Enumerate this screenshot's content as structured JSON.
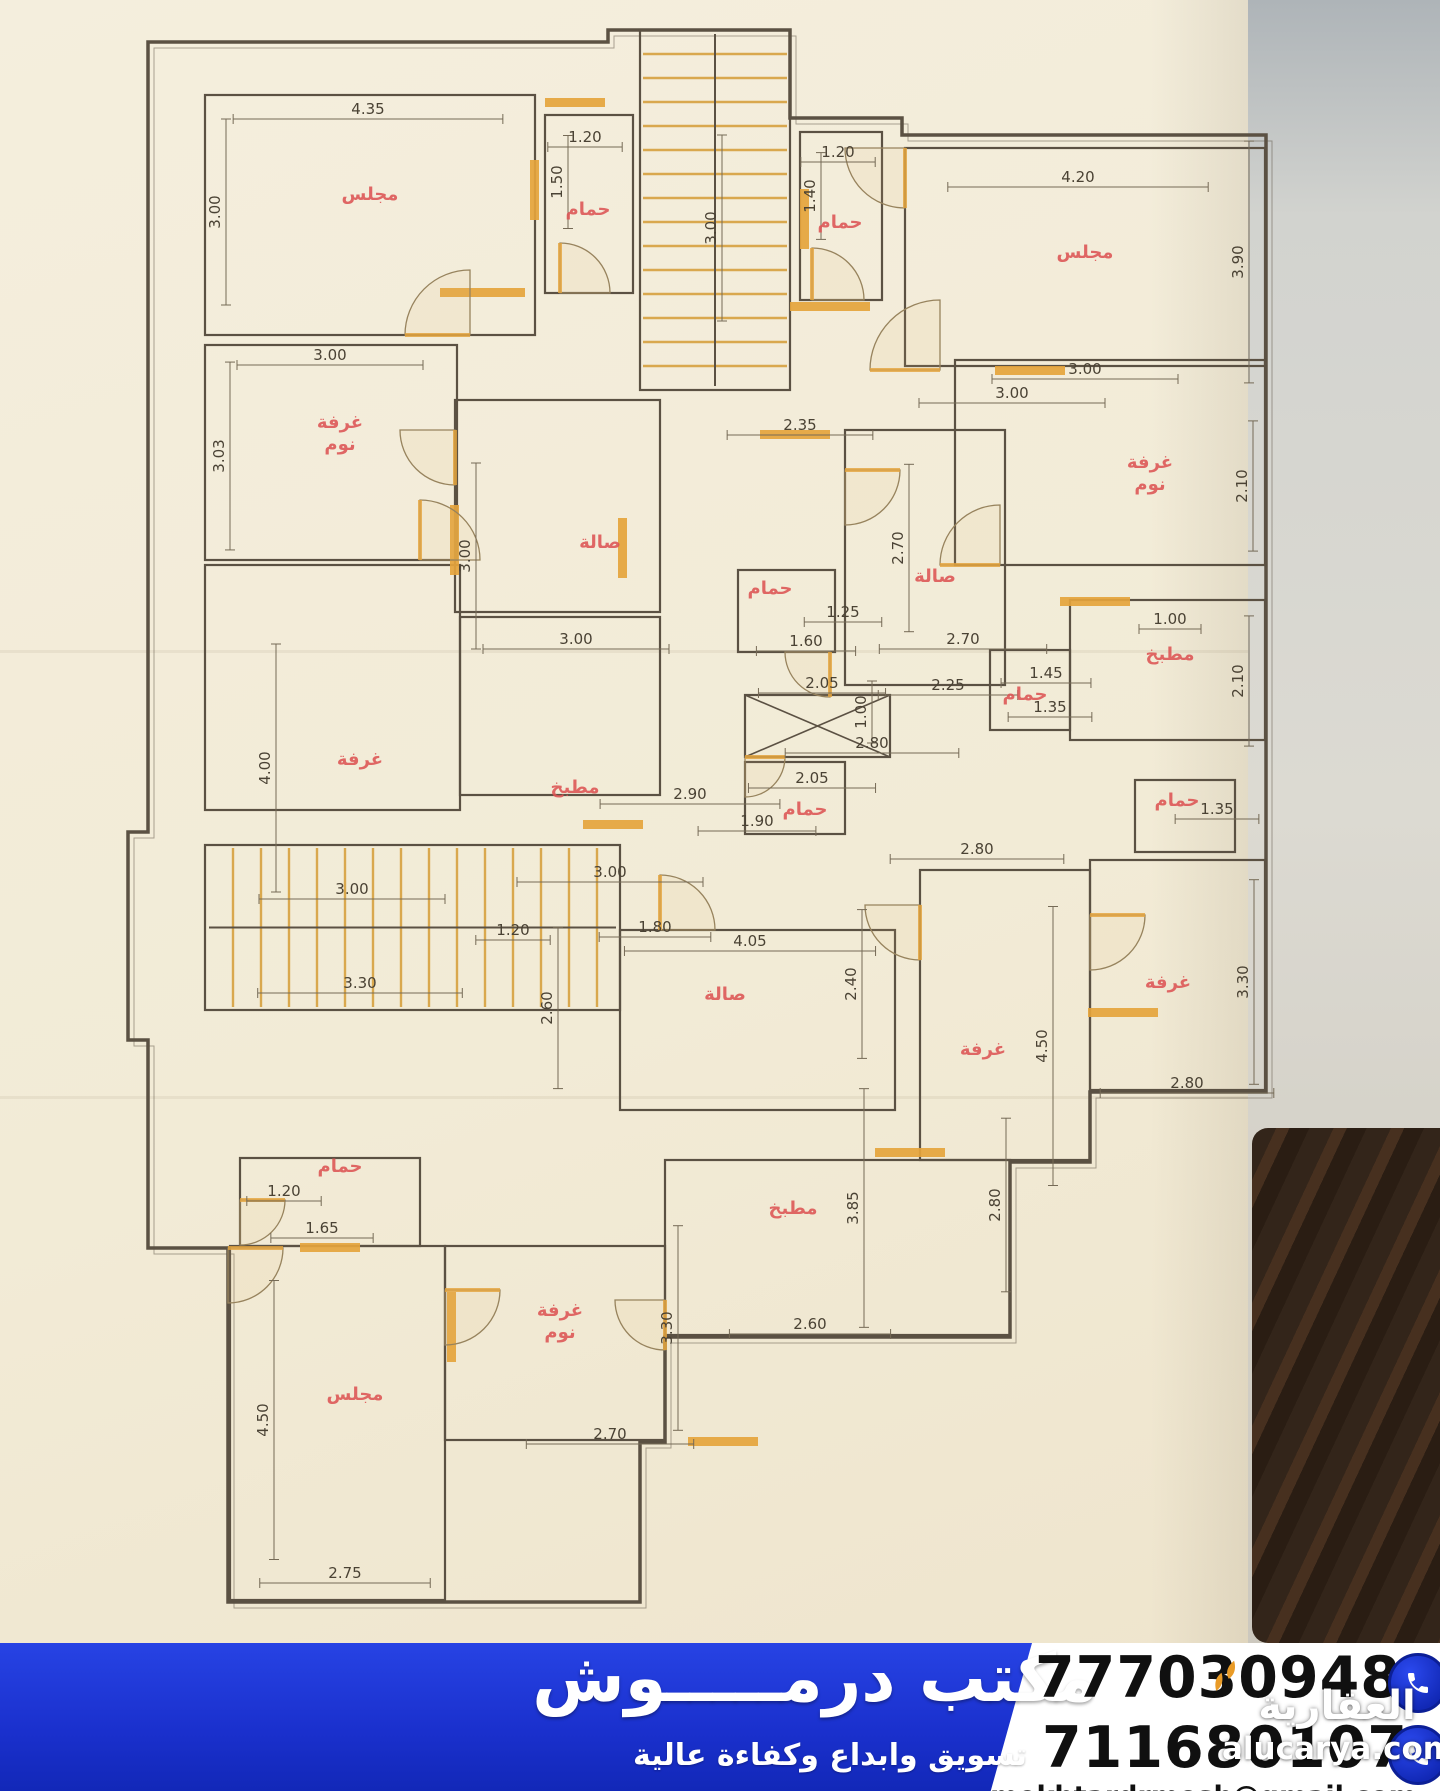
{
  "photo": {
    "paper_color": "#f2ebd6",
    "wall_color": "#d2d3cf",
    "dark_object_color": "#33251a",
    "crease_y1": 650,
    "crease_y2": 1096
  },
  "plan": {
    "ink": "#5b5143",
    "dim": "#4a4234",
    "dimline": "#756a56",
    "label": "#dd5454",
    "column_red": "#f3503a",
    "column_pink": "#ef5d8e",
    "accent": "#e5a43c",
    "stair": "#d9a84e",
    "outline": "148,42 608,42 608,30 790,30 790,118 902,118 902,135 1266,135 1266,1092 1090,1092 1090,1162 1010,1162 1010,1337 665,1337 665,1442 640,1442 640,1602 228,1602 228,1248 148,1248 148,1040 128,1040 128,832 148,832",
    "rooms": [
      [
        205,
        95,
        330,
        240
      ],
      [
        545,
        115,
        88,
        178
      ],
      [
        800,
        132,
        82,
        168
      ],
      [
        905,
        148,
        360,
        218
      ],
      [
        205,
        345,
        252,
        215
      ],
      [
        455,
        400,
        205,
        212
      ],
      [
        845,
        430,
        160,
        255
      ],
      [
        955,
        360,
        310,
        205
      ],
      [
        738,
        570,
        97,
        82
      ],
      [
        745,
        762,
        100,
        72
      ],
      [
        205,
        565,
        255,
        245
      ],
      [
        460,
        617,
        200,
        178
      ],
      [
        1070,
        600,
        195,
        140
      ],
      [
        990,
        650,
        80,
        80
      ],
      [
        620,
        930,
        275,
        180
      ],
      [
        920,
        870,
        170,
        290
      ],
      [
        1090,
        860,
        175,
        230
      ],
      [
        1135,
        780,
        100,
        72
      ],
      [
        665,
        1160,
        345,
        175
      ],
      [
        240,
        1158,
        180,
        88
      ],
      [
        230,
        1246,
        215,
        354
      ],
      [
        445,
        1246,
        220,
        194
      ]
    ],
    "stairs": [
      [
        640,
        30,
        150,
        360,
        "h",
        24
      ],
      [
        205,
        845,
        415,
        165,
        "v",
        28
      ]
    ],
    "elevator": [
      745,
      695,
      145,
      62
    ],
    "columns": [
      [
        0,
        6,
        24,
        10
      ],
      [
        612,
        0,
        44,
        12
      ],
      [
        150,
        36,
        64,
        26
      ],
      [
        368,
        64,
        58,
        22
      ],
      [
        754,
        22,
        58,
        22
      ],
      [
        598,
        100,
        24,
        54
      ],
      [
        788,
        116,
        22,
        50,
        1
      ],
      [
        948,
        116,
        58,
        22
      ],
      [
        1096,
        92,
        58,
        22
      ],
      [
        172,
        296,
        62,
        24
      ],
      [
        340,
        314,
        56,
        20
      ],
      [
        940,
        318,
        24,
        56
      ],
      [
        1102,
        330,
        56,
        22
      ],
      [
        148,
        518,
        24,
        60
      ],
      [
        362,
        518,
        58,
        22
      ],
      [
        580,
        444,
        60,
        20,
        1
      ],
      [
        650,
        597,
        22,
        48,
        1
      ],
      [
        200,
        648,
        70,
        26
      ],
      [
        878,
        678,
        24,
        56
      ],
      [
        1240,
        560,
        22,
        50
      ],
      [
        722,
        858,
        22,
        52
      ],
      [
        893,
        963,
        22,
        52
      ],
      [
        300,
        841,
        62,
        24
      ],
      [
        940,
        848,
        58,
        22
      ],
      [
        1240,
        893,
        20,
        60
      ],
      [
        545,
        1098,
        22,
        60
      ],
      [
        975,
        1143,
        22,
        60
      ],
      [
        205,
        1150,
        60,
        24
      ],
      [
        878,
        1110,
        60,
        22
      ],
      [
        1158,
        998,
        20,
        55
      ],
      [
        222,
        1393,
        24,
        60
      ],
      [
        272,
        1438,
        26,
        80
      ]
    ],
    "sills": [
      [
        440,
        288,
        85,
        9
      ],
      [
        545,
        98,
        60,
        9
      ],
      [
        790,
        302,
        80,
        9
      ],
      [
        995,
        366,
        70,
        9
      ],
      [
        450,
        505,
        9,
        70
      ],
      [
        618,
        518,
        9,
        60
      ],
      [
        760,
        430,
        70,
        9
      ],
      [
        1060,
        597,
        70,
        9
      ],
      [
        875,
        1148,
        70,
        9
      ],
      [
        688,
        1437,
        70,
        9
      ],
      [
        447,
        1292,
        9,
        70
      ],
      [
        1088,
        1008,
        70,
        9
      ],
      [
        583,
        820,
        60,
        9
      ],
      [
        300,
        1243,
        60,
        9
      ],
      [
        800,
        189,
        9,
        60
      ],
      [
        530,
        160,
        9,
        60
      ]
    ],
    "doors": [
      [
        470,
        335,
        65,
        180
      ],
      [
        560,
        293,
        50,
        270
      ],
      [
        812,
        300,
        52,
        270
      ],
      [
        940,
        370,
        70,
        180
      ],
      [
        420,
        560,
        60,
        270
      ],
      [
        455,
        430,
        55,
        90
      ],
      [
        845,
        470,
        55,
        0
      ],
      [
        1000,
        565,
        60,
        180
      ],
      [
        830,
        652,
        45,
        90
      ],
      [
        745,
        757,
        40,
        0
      ],
      [
        660,
        930,
        55,
        270
      ],
      [
        920,
        905,
        55,
        90
      ],
      [
        1090,
        915,
        55,
        0
      ],
      [
        445,
        1290,
        55,
        0
      ],
      [
        665,
        1300,
        50,
        90
      ],
      [
        240,
        1200,
        45,
        0
      ],
      [
        905,
        148,
        60,
        90
      ],
      [
        228,
        1248,
        55,
        0
      ]
    ],
    "dims": [
      [
        "4.35",
        368,
        112,
        0
      ],
      [
        "3.00",
        220,
        212,
        1
      ],
      [
        "1.20",
        585,
        140,
        0
      ],
      [
        "1.50",
        562,
        182,
        1
      ],
      [
        "3.00",
        716,
        228,
        1
      ],
      [
        "1.20",
        838,
        155,
        0
      ],
      [
        "1.40",
        815,
        196,
        1
      ],
      [
        "4.20",
        1078,
        180,
        0
      ],
      [
        "3.90",
        1243,
        262,
        1
      ],
      [
        "3.00",
        1012,
        396,
        0
      ],
      [
        "3.00",
        330,
        358,
        0
      ],
      [
        "3.03",
        224,
        456,
        1
      ],
      [
        "2.35",
        800,
        428,
        0
      ],
      [
        "3.00",
        470,
        556,
        1
      ],
      [
        "3.00",
        576,
        642,
        0
      ],
      [
        "2.70",
        903,
        548,
        1
      ],
      [
        "2.70",
        963,
        642,
        0
      ],
      [
        "2.25",
        948,
        688,
        0
      ],
      [
        "3.00",
        1085,
        372,
        0
      ],
      [
        "2.10",
        1247,
        486,
        1
      ],
      [
        "1.00",
        1170,
        622,
        0
      ],
      [
        "2.10",
        1243,
        681,
        1
      ],
      [
        "1.45",
        1046,
        676,
        0
      ],
      [
        "1.35",
        1050,
        710,
        0
      ],
      [
        "1.25",
        843,
        615,
        0
      ],
      [
        "1.60",
        806,
        644,
        0
      ],
      [
        "2.05",
        822,
        686,
        0
      ],
      [
        "1.00",
        866,
        712,
        1
      ],
      [
        "2.05",
        812,
        781,
        0
      ],
      [
        "1.90",
        757,
        824,
        0
      ],
      [
        "4.00",
        270,
        768,
        1
      ],
      [
        "2.90",
        690,
        797,
        0
      ],
      [
        "3.00",
        610,
        875,
        0
      ],
      [
        "3.00",
        352,
        892,
        0
      ],
      [
        "3.30",
        360,
        986,
        0
      ],
      [
        "1.20",
        513,
        933,
        0
      ],
      [
        "1.80",
        655,
        930,
        0
      ],
      [
        "4.05",
        750,
        944,
        0
      ],
      [
        "2.40",
        856,
        984,
        1
      ],
      [
        "2.60",
        552,
        1008,
        1
      ],
      [
        "2.80",
        977,
        852,
        0
      ],
      [
        "1.35",
        1217,
        812,
        0
      ],
      [
        "3.30",
        1248,
        982,
        1
      ],
      [
        "2.80",
        1187,
        1086,
        0
      ],
      [
        "4.50",
        1047,
        1046,
        1
      ],
      [
        "1.20",
        284,
        1194,
        0
      ],
      [
        "1.65",
        322,
        1231,
        0
      ],
      [
        "3.85",
        858,
        1208,
        1
      ],
      [
        "2.80",
        1000,
        1205,
        1
      ],
      [
        "2.60",
        810,
        1327,
        0
      ],
      [
        "3.30",
        672,
        1328,
        1
      ],
      [
        "2.70",
        610,
        1437,
        0
      ],
      [
        "4.50",
        268,
        1420,
        1
      ],
      [
        "2.75",
        345,
        1576,
        0
      ],
      [
        "2.80",
        872,
        746,
        0
      ]
    ],
    "labels": [
      [
        "مجلس",
        370,
        200
      ],
      [
        "حمام",
        588,
        215
      ],
      [
        "حمام",
        840,
        228
      ],
      [
        "مجلس",
        1085,
        258
      ],
      [
        "غرفة|نوم",
        340,
        428
      ],
      [
        "صالة",
        600,
        548
      ],
      [
        "غرفة|نوم",
        1150,
        468
      ],
      [
        "صالة",
        935,
        582
      ],
      [
        "حمام",
        770,
        594
      ],
      [
        "مطبخ",
        1170,
        660
      ],
      [
        "حمام",
        1025,
        700
      ],
      [
        "غرفة",
        360,
        765
      ],
      [
        "مطبخ",
        575,
        793
      ],
      [
        "حمام",
        805,
        815
      ],
      [
        "صالة",
        725,
        1000
      ],
      [
        "حمام",
        1177,
        806
      ],
      [
        "غرفة",
        1168,
        988
      ],
      [
        "غرفة",
        983,
        1055
      ],
      [
        "مطبخ",
        793,
        1214
      ],
      [
        "حمام",
        340,
        1172
      ],
      [
        "غرفة|نوم",
        560,
        1316
      ],
      [
        "مجلس",
        355,
        1400
      ]
    ]
  },
  "banner": {
    "title": "مكتب درمـــــوش",
    "subtitle": "تسويق وابداع وكفاءة عالية",
    "phone1": "777030948",
    "phone2": "711680107",
    "email": "mekhtardrmosh@gmail.com"
  },
  "watermark": {
    "name_ar": "العقارية",
    "domain": "alucarya.com",
    "leaf_color": "#e99b27"
  }
}
